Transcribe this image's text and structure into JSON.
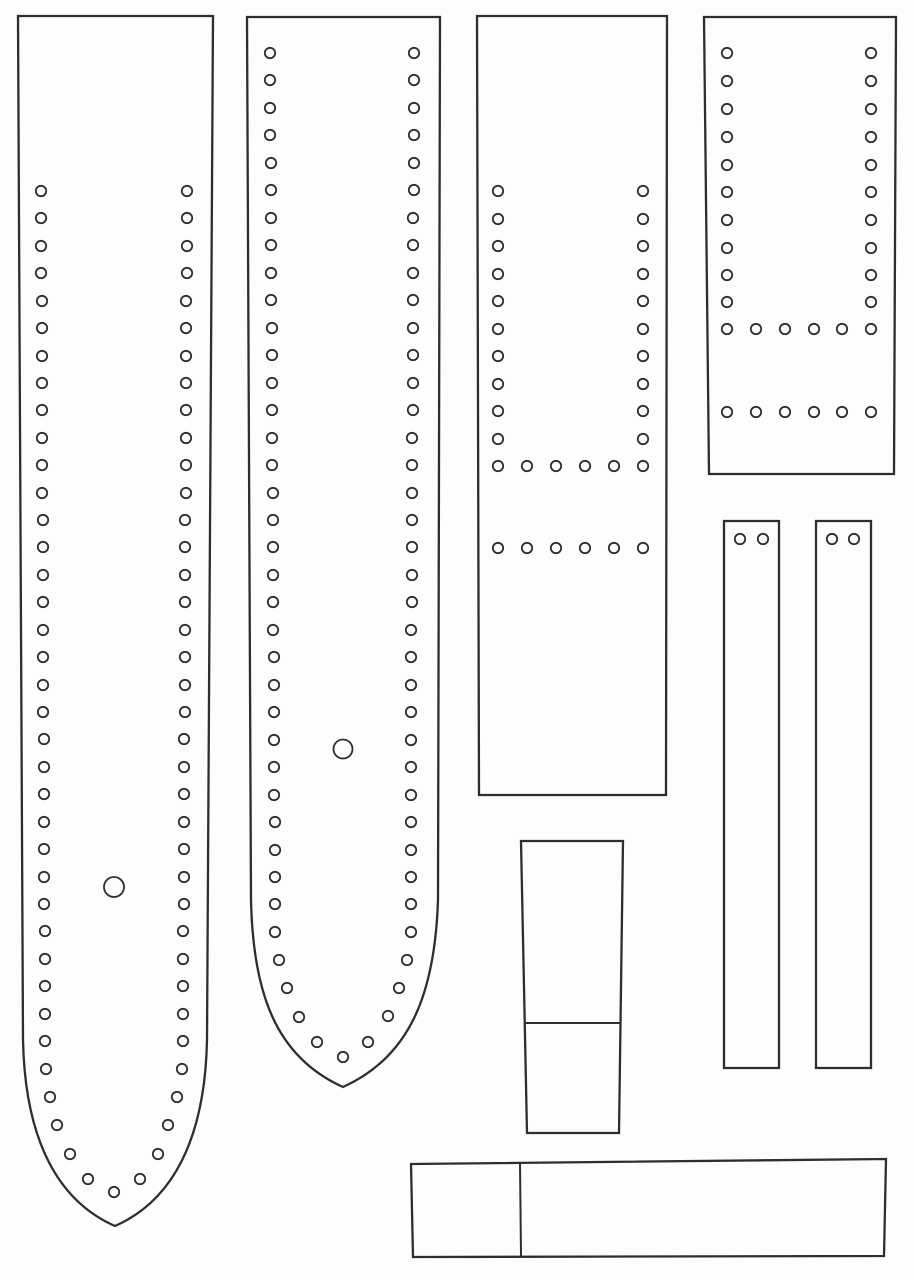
{
  "meta": {
    "description": "leather strap / watch-band craft pattern sheet with stitching holes",
    "background_color": "#fdfdfd",
    "line_color": "#2e2e2e",
    "outline_stroke_width": 2.3,
    "hole_stroke_width": 1.8,
    "divider_stroke_width": 2
  },
  "pattern": {
    "pieces": [
      {
        "name": "strap-long-tapered-left",
        "outline": "M 18 16 L 213 16 L 207 1040 C 205 1140 172 1201 115 1226 C 58 1201 25 1140 23 1040 Z",
        "hole_r": 5.2,
        "holes": [
          [
            41,
            191
          ],
          [
            41,
            218
          ],
          [
            41,
            246
          ],
          [
            41,
            273
          ],
          [
            42,
            301
          ],
          [
            42,
            328
          ],
          [
            42,
            356
          ],
          [
            42,
            383
          ],
          [
            42,
            410
          ],
          [
            42,
            438
          ],
          [
            42,
            465
          ],
          [
            42,
            493
          ],
          [
            43,
            520
          ],
          [
            43,
            547
          ],
          [
            43,
            575
          ],
          [
            43,
            602
          ],
          [
            43,
            630
          ],
          [
            43,
            657
          ],
          [
            43,
            685
          ],
          [
            43,
            712
          ],
          [
            44,
            739
          ],
          [
            44,
            767
          ],
          [
            44,
            794
          ],
          [
            44,
            822
          ],
          [
            44,
            849
          ],
          [
            44,
            877
          ],
          [
            44,
            904
          ],
          [
            45,
            931
          ],
          [
            45,
            959
          ],
          [
            45,
            986
          ],
          [
            45,
            1014
          ],
          [
            45,
            1041
          ],
          [
            46,
            1069
          ],
          [
            50,
            1097
          ],
          [
            57,
            1125
          ],
          [
            70,
            1154
          ],
          [
            88,
            1179
          ],
          [
            114,
            1192
          ],
          [
            140,
            1179
          ],
          [
            158,
            1154
          ],
          [
            168,
            1125
          ],
          [
            177,
            1097
          ],
          [
            182,
            1069
          ],
          [
            183,
            1041
          ],
          [
            183,
            1014
          ],
          [
            183,
            986
          ],
          [
            183,
            959
          ],
          [
            183,
            931
          ],
          [
            184,
            904
          ],
          [
            184,
            877
          ],
          [
            184,
            849
          ],
          [
            184,
            822
          ],
          [
            184,
            794
          ],
          [
            184,
            767
          ],
          [
            184,
            739
          ],
          [
            185,
            712
          ],
          [
            185,
            685
          ],
          [
            185,
            657
          ],
          [
            185,
            630
          ],
          [
            185,
            602
          ],
          [
            185,
            575
          ],
          [
            185,
            547
          ],
          [
            185,
            520
          ],
          [
            186,
            493
          ],
          [
            186,
            465
          ],
          [
            186,
            438
          ],
          [
            186,
            410
          ],
          [
            186,
            383
          ],
          [
            186,
            356
          ],
          [
            186,
            328
          ],
          [
            186,
            301
          ],
          [
            187,
            273
          ],
          [
            187,
            246
          ],
          [
            187,
            218
          ],
          [
            187,
            191
          ]
        ],
        "big_holes": [
          [
            114,
            887,
            10
          ]
        ],
        "dividers": []
      },
      {
        "name": "strap-long-rounded-second",
        "outline": "M 247 17 L 440 17 L 438 900 C 435 990 412 1056 343 1087 C 274 1056 253 990 251 900 Z",
        "hole_r": 5.2,
        "holes": [
          [
            270,
            53
          ],
          [
            270,
            80
          ],
          [
            270,
            108
          ],
          [
            270,
            135
          ],
          [
            271,
            163
          ],
          [
            271,
            190
          ],
          [
            271,
            218
          ],
          [
            271,
            245
          ],
          [
            271,
            273
          ],
          [
            271,
            300
          ],
          [
            272,
            328
          ],
          [
            272,
            355
          ],
          [
            272,
            383
          ],
          [
            272,
            410
          ],
          [
            272,
            438
          ],
          [
            272,
            465
          ],
          [
            273,
            493
          ],
          [
            273,
            520
          ],
          [
            273,
            547
          ],
          [
            273,
            575
          ],
          [
            273,
            602
          ],
          [
            273,
            630
          ],
          [
            274,
            657
          ],
          [
            274,
            685
          ],
          [
            274,
            712
          ],
          [
            274,
            740
          ],
          [
            274,
            767
          ],
          [
            274,
            795
          ],
          [
            275,
            822
          ],
          [
            275,
            850
          ],
          [
            275,
            877
          ],
          [
            275,
            904
          ],
          [
            275,
            932
          ],
          [
            279,
            960
          ],
          [
            287,
            988
          ],
          [
            299,
            1017
          ],
          [
            317,
            1042
          ],
          [
            343,
            1057
          ],
          [
            368,
            1042
          ],
          [
            388,
            1016
          ],
          [
            399,
            988
          ],
          [
            407,
            960
          ],
          [
            411,
            932
          ],
          [
            411,
            904
          ],
          [
            411,
            877
          ],
          [
            411,
            850
          ],
          [
            411,
            822
          ],
          [
            411,
            795
          ],
          [
            411,
            767
          ],
          [
            411,
            740
          ],
          [
            411,
            712
          ],
          [
            411,
            685
          ],
          [
            411,
            657
          ],
          [
            411,
            630
          ],
          [
            412,
            602
          ],
          [
            412,
            575
          ],
          [
            412,
            547
          ],
          [
            412,
            520
          ],
          [
            412,
            493
          ],
          [
            412,
            465
          ],
          [
            412,
            438
          ],
          [
            413,
            410
          ],
          [
            413,
            383
          ],
          [
            413,
            355
          ],
          [
            413,
            328
          ],
          [
            413,
            300
          ],
          [
            413,
            273
          ],
          [
            413,
            245
          ],
          [
            413,
            218
          ],
          [
            414,
            190
          ],
          [
            414,
            163
          ],
          [
            414,
            135
          ],
          [
            414,
            108
          ],
          [
            414,
            80
          ],
          [
            414,
            53
          ]
        ],
        "big_holes": [
          [
            343,
            749,
            9.5
          ]
        ],
        "dividers": []
      },
      {
        "name": "rect-panel-center",
        "outline": "M 477 16 L 667 16 L 666 795 L 479 795 Z",
        "hole_r": 5.2,
        "holes": [
          [
            498,
            191
          ],
          [
            498,
            219
          ],
          [
            498,
            246
          ],
          [
            498,
            274
          ],
          [
            498,
            301
          ],
          [
            498,
            329
          ],
          [
            498,
            356
          ],
          [
            498,
            384
          ],
          [
            498,
            411
          ],
          [
            498,
            439
          ],
          [
            643,
            191
          ],
          [
            643,
            219
          ],
          [
            643,
            246
          ],
          [
            643,
            274
          ],
          [
            643,
            301
          ],
          [
            643,
            329
          ],
          [
            643,
            356
          ],
          [
            643,
            384
          ],
          [
            643,
            411
          ],
          [
            643,
            439
          ],
          [
            498,
            466
          ],
          [
            527,
            466
          ],
          [
            556,
            466
          ],
          [
            585,
            466
          ],
          [
            614,
            466
          ],
          [
            643,
            466
          ],
          [
            498,
            548
          ],
          [
            527,
            548
          ],
          [
            556,
            548
          ],
          [
            585,
            548
          ],
          [
            614,
            548
          ],
          [
            643,
            548
          ]
        ],
        "big_holes": [],
        "dividers": []
      },
      {
        "name": "rect-panel-top-right",
        "outline": "M 704 17 L 896 17 L 894 474 L 709 474 Z",
        "hole_r": 5.2,
        "holes": [
          [
            727,
            53
          ],
          [
            727,
            81
          ],
          [
            727,
            109
          ],
          [
            727,
            137
          ],
          [
            727,
            165
          ],
          [
            727,
            192
          ],
          [
            727,
            220
          ],
          [
            727,
            248
          ],
          [
            727,
            275
          ],
          [
            727,
            302
          ],
          [
            871,
            53
          ],
          [
            871,
            81
          ],
          [
            871,
            109
          ],
          [
            871,
            137
          ],
          [
            871,
            165
          ],
          [
            871,
            192
          ],
          [
            871,
            220
          ],
          [
            871,
            248
          ],
          [
            871,
            275
          ],
          [
            871,
            302
          ],
          [
            727,
            329
          ],
          [
            756,
            329
          ],
          [
            785,
            329
          ],
          [
            814,
            329
          ],
          [
            842,
            329
          ],
          [
            871,
            329
          ],
          [
            727,
            412
          ],
          [
            756,
            412
          ],
          [
            785,
            412
          ],
          [
            814,
            412
          ],
          [
            842,
            412
          ],
          [
            871,
            412
          ]
        ],
        "big_holes": [],
        "dividers": []
      },
      {
        "name": "strip-narrow-left",
        "outline": "M 724 521 L 779 521 L 779 1068 L 724 1068 Z",
        "hole_r": 5.2,
        "holes": [
          [
            740,
            539
          ],
          [
            763,
            539
          ]
        ],
        "big_holes": [],
        "dividers": []
      },
      {
        "name": "strip-narrow-right",
        "outline": "M 816 521 L 871 521 L 871 1068 L 816 1068 Z",
        "hole_r": 5.2,
        "holes": [
          [
            832,
            539
          ],
          [
            854,
            539
          ]
        ],
        "big_holes": [],
        "dividers": []
      },
      {
        "name": "keeper-block-bottom-center",
        "outline": "M 521 841 L 623 841 L 619 1133 L 527 1133 Z",
        "hole_r": 5.2,
        "holes": [],
        "big_holes": [],
        "dividers": [
          [
            524,
            1023,
            621,
            1023
          ]
        ]
      },
      {
        "name": "bar-bottom-horizontal",
        "outline": "M 411 1164 L 886 1159 L 884 1256 L 413 1257 Z",
        "hole_r": 5.2,
        "holes": [],
        "big_holes": [],
        "dividers": [
          [
            520,
            1163,
            521,
            1256
          ]
        ]
      }
    ]
  }
}
